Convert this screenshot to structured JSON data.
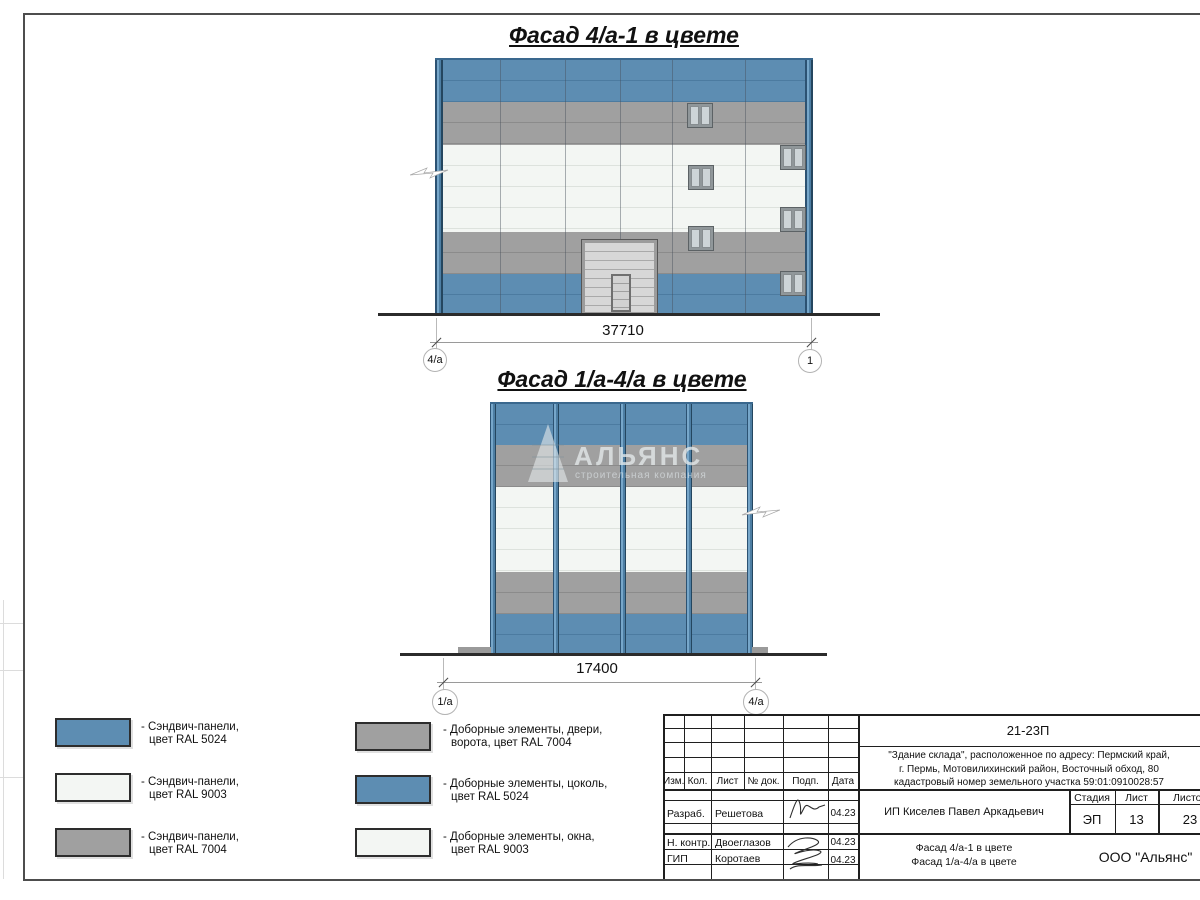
{
  "titles": {
    "facade1": "Фасад 4/а-1 в цвете",
    "facade2": "Фасад 1/а-4/а в цвете"
  },
  "dimensions": {
    "facade1_width": "37710",
    "facade2_width": "17400"
  },
  "axes": {
    "f1_left": "4/а",
    "f1_right": "1",
    "f2_left": "1/а",
    "f2_right": "4/а"
  },
  "watermark": {
    "name": "АЛЬЯНС",
    "tagline": "строительная компания"
  },
  "legend": {
    "items": [
      {
        "color": "#5d8db2",
        "line1": "- Сэндвич-панели,",
        "line2": "цвет RAL 5024"
      },
      {
        "color": "#f3f6f3",
        "line1": "- Сэндвич-панели,",
        "line2": "цвет RAL 9003"
      },
      {
        "color": "#a0a0a0",
        "line1": "- Сэндвич-панели,",
        "line2": "цвет RAL 7004"
      },
      {
        "color": "#a0a0a0",
        "line1": "- Доборные элементы, двери,",
        "line2": "ворота, цвет RAL 7004"
      },
      {
        "color": "#5d8db2",
        "line1": "- Доборные элементы, цоколь,",
        "line2": "цвет RAL 5024"
      },
      {
        "color": "#f3f6f3",
        "line1": "- Доборные элементы, окна,",
        "line2": "цвет RAL 9003"
      }
    ]
  },
  "title_block": {
    "doc_number": "21-23П",
    "address_line1": "\"Здание склада\", расположенное по адресу: Пермский край,",
    "address_line2": "г. Пермь, Мотовилихинский район, Восточный обход, 80",
    "address_line3": "кадастровый номер земельного участка 59:01:0910028:57",
    "col_izm": "Изм.",
    "col_kol": "Кол.",
    "col_list": "Лист",
    "col_doc": "№ док.",
    "col_podp": "Подп.",
    "col_data": "Дата",
    "row1_role": "Разраб.",
    "row1_name": "Решетова",
    "row1_date": "04.23",
    "row2_role": "Н. контр.",
    "row2_name": "Двоеглазов",
    "row2_date": "04.23",
    "row3_role": "ГИП",
    "row3_name": "Коротаев",
    "row3_date": "04.23",
    "client": "ИП Киселев Павел Аркадьевич",
    "stage_label": "Стадия",
    "sheet_label": "Лист",
    "sheets_label": "Листов",
    "stage": "ЭП",
    "sheet_num": "13",
    "sheets_total": "23",
    "drawing_title_line1": "Фасад 4/а-1 в цвете",
    "drawing_title_line2": "Фасад 1/а-4/а в цвете",
    "company": "ООО \"Альянс\""
  },
  "colors": {
    "panel_blue": "#5d8db2",
    "panel_white": "#f3f6f3",
    "panel_gray": "#a0a0a0"
  }
}
